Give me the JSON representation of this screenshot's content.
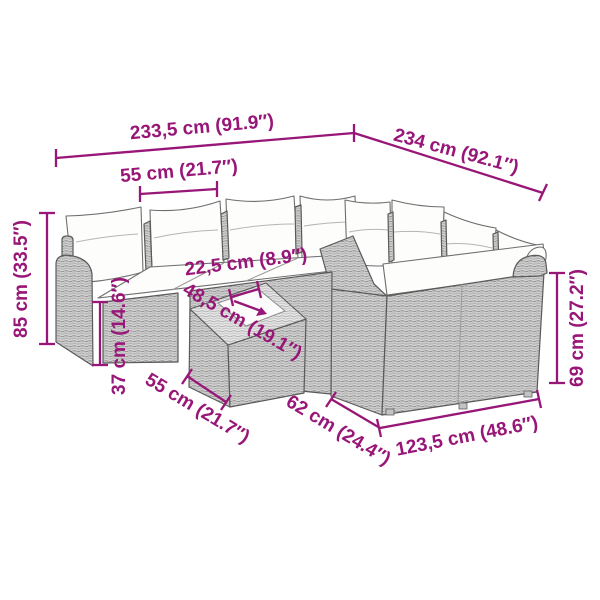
{
  "colors": {
    "dimension": "#981677",
    "wicker_light": "#d6d6d6",
    "wicker_dark": "#8e8e8e",
    "cushion": "#fdfdfc",
    "background": "#ffffff"
  },
  "illustration": {
    "description": "modular poly-rattan corner lounge sofa set with white cushions and coffee table, isometric line drawing"
  },
  "dimensions": {
    "back_width": "233,5 cm (91.9″)",
    "side_length": "234 cm (92.1″)",
    "seat_width": "55 cm (21.7″)",
    "total_height": "85 cm (33.5″)",
    "seat_height": "37 cm (14.6″)",
    "table_gap": "22,5 cm (8.9″)",
    "table_width": "48,5 cm (19.1″)",
    "table_depth": "55 cm (21.7″)",
    "sofa_depth": "62 cm (24.4″)",
    "front_width": "123,5 cm (48.6″)",
    "back_height": "69 cm (27.2″)"
  }
}
